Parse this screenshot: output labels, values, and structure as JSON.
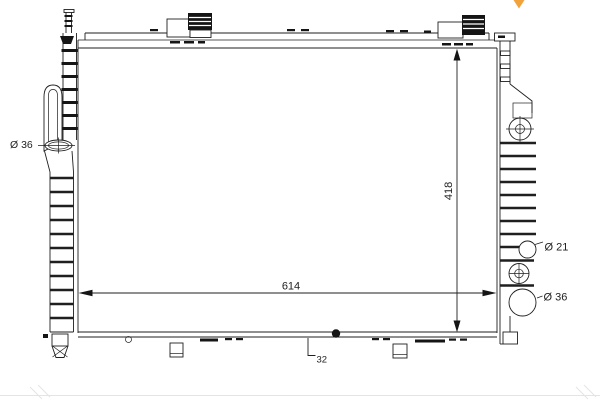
{
  "canvas": {
    "background": "#ffffff",
    "line_color": "#1f1f1f"
  },
  "watermark": {
    "color": "#F2A23A"
  },
  "drawing": {
    "subject": "radiator technical drawing",
    "labels": {
      "left_inlet_diameter": "Ø 36",
      "height_dimension": "418",
      "width_dimension": "614",
      "bottom_depth_dimension": "32",
      "right_upper_port_diameter": "Ø 21",
      "right_lower_port_diameter": "Ø 36"
    }
  }
}
